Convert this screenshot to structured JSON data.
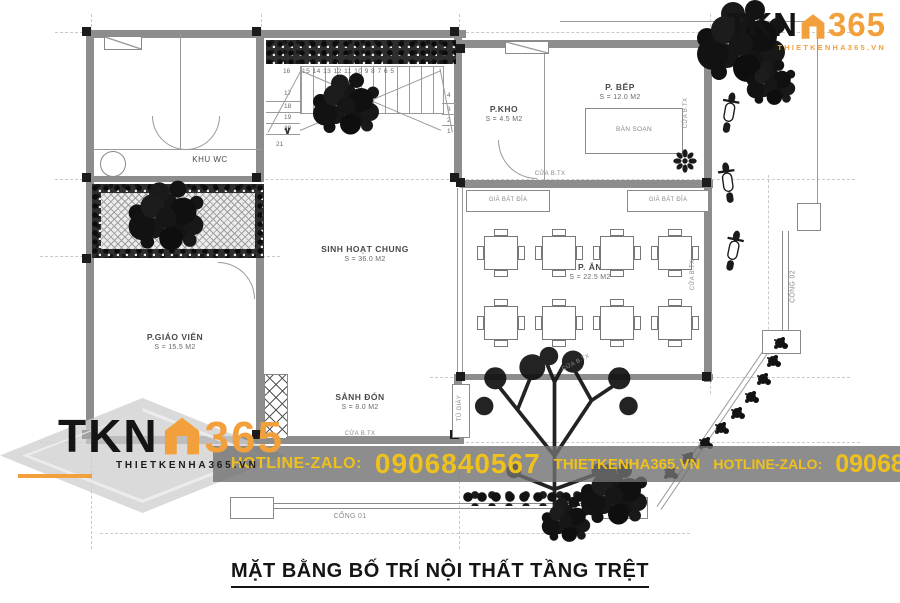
{
  "title": "MẶT BẰNG BỐ TRÍ NỘI THẤT TẦNG TRỆT",
  "branding": {
    "logo_text": "TKN",
    "logo_number": "365",
    "logo_site_top": "THIETKENHA365.VN",
    "logo_site_bottom": "THIETKENHA365.VN",
    "accent_orange": "#F2A03C",
    "banner_yellow": "#EFC11D"
  },
  "banner": {
    "hotline_label_left": "HOTLINE-ZALO:",
    "hotline_number_left": "0906840567",
    "site": "THIETKENHA365.VN",
    "hotline_label_right": "HOTLINE-ZALO:",
    "hotline_number_right": "0906840567"
  },
  "plan": {
    "rooms": {
      "khu_wc": {
        "name": "KHU WC"
      },
      "p_kho": {
        "name": "P.KHO",
        "area": "S = 4.5 M2"
      },
      "p_bep": {
        "name": "P. BẾP",
        "area": "S = 12.0 M2"
      },
      "sinh_hoat_chung": {
        "name": "SINH HOẠT CHUNG",
        "area": "S = 36.0 M2"
      },
      "p_an": {
        "name": "P. ĂN",
        "area": "S = 22.5 M2"
      },
      "p_giao_vien": {
        "name": "P.GIÁO VIÊN",
        "area": "S = 15.5 M2"
      },
      "sanh_don": {
        "name": "SẢNH ĐÓN",
        "area": "S = 8.0 M2"
      }
    },
    "furniture": {
      "prep_table": "BÀN SOẠN",
      "dish_rack_left": "GIÁ BÁT ĐĨA",
      "dish_rack_right": "GIÁ BÁT ĐĨA",
      "shoe_cabinet": "TỦ GIÀY"
    },
    "doors": {
      "kitchen_door": "CỬA B.TX",
      "hall_door": "CỬA B.TX",
      "kitchen_side_door": "CỬA B.TX",
      "dining_side_door": "CỬA B.TX",
      "yard_door": "CỬA B.TX"
    },
    "gates": {
      "gate_01": "CỔNG 01",
      "gate_02": "CỔNG 02"
    },
    "stairs": {
      "top_row": "15 14 13 12 11 10 9 8 7 6 5",
      "first": "16",
      "left": [
        "17",
        "18",
        "19",
        "20",
        "21"
      ],
      "right": [
        "4",
        "3",
        "2",
        "1"
      ]
    }
  }
}
